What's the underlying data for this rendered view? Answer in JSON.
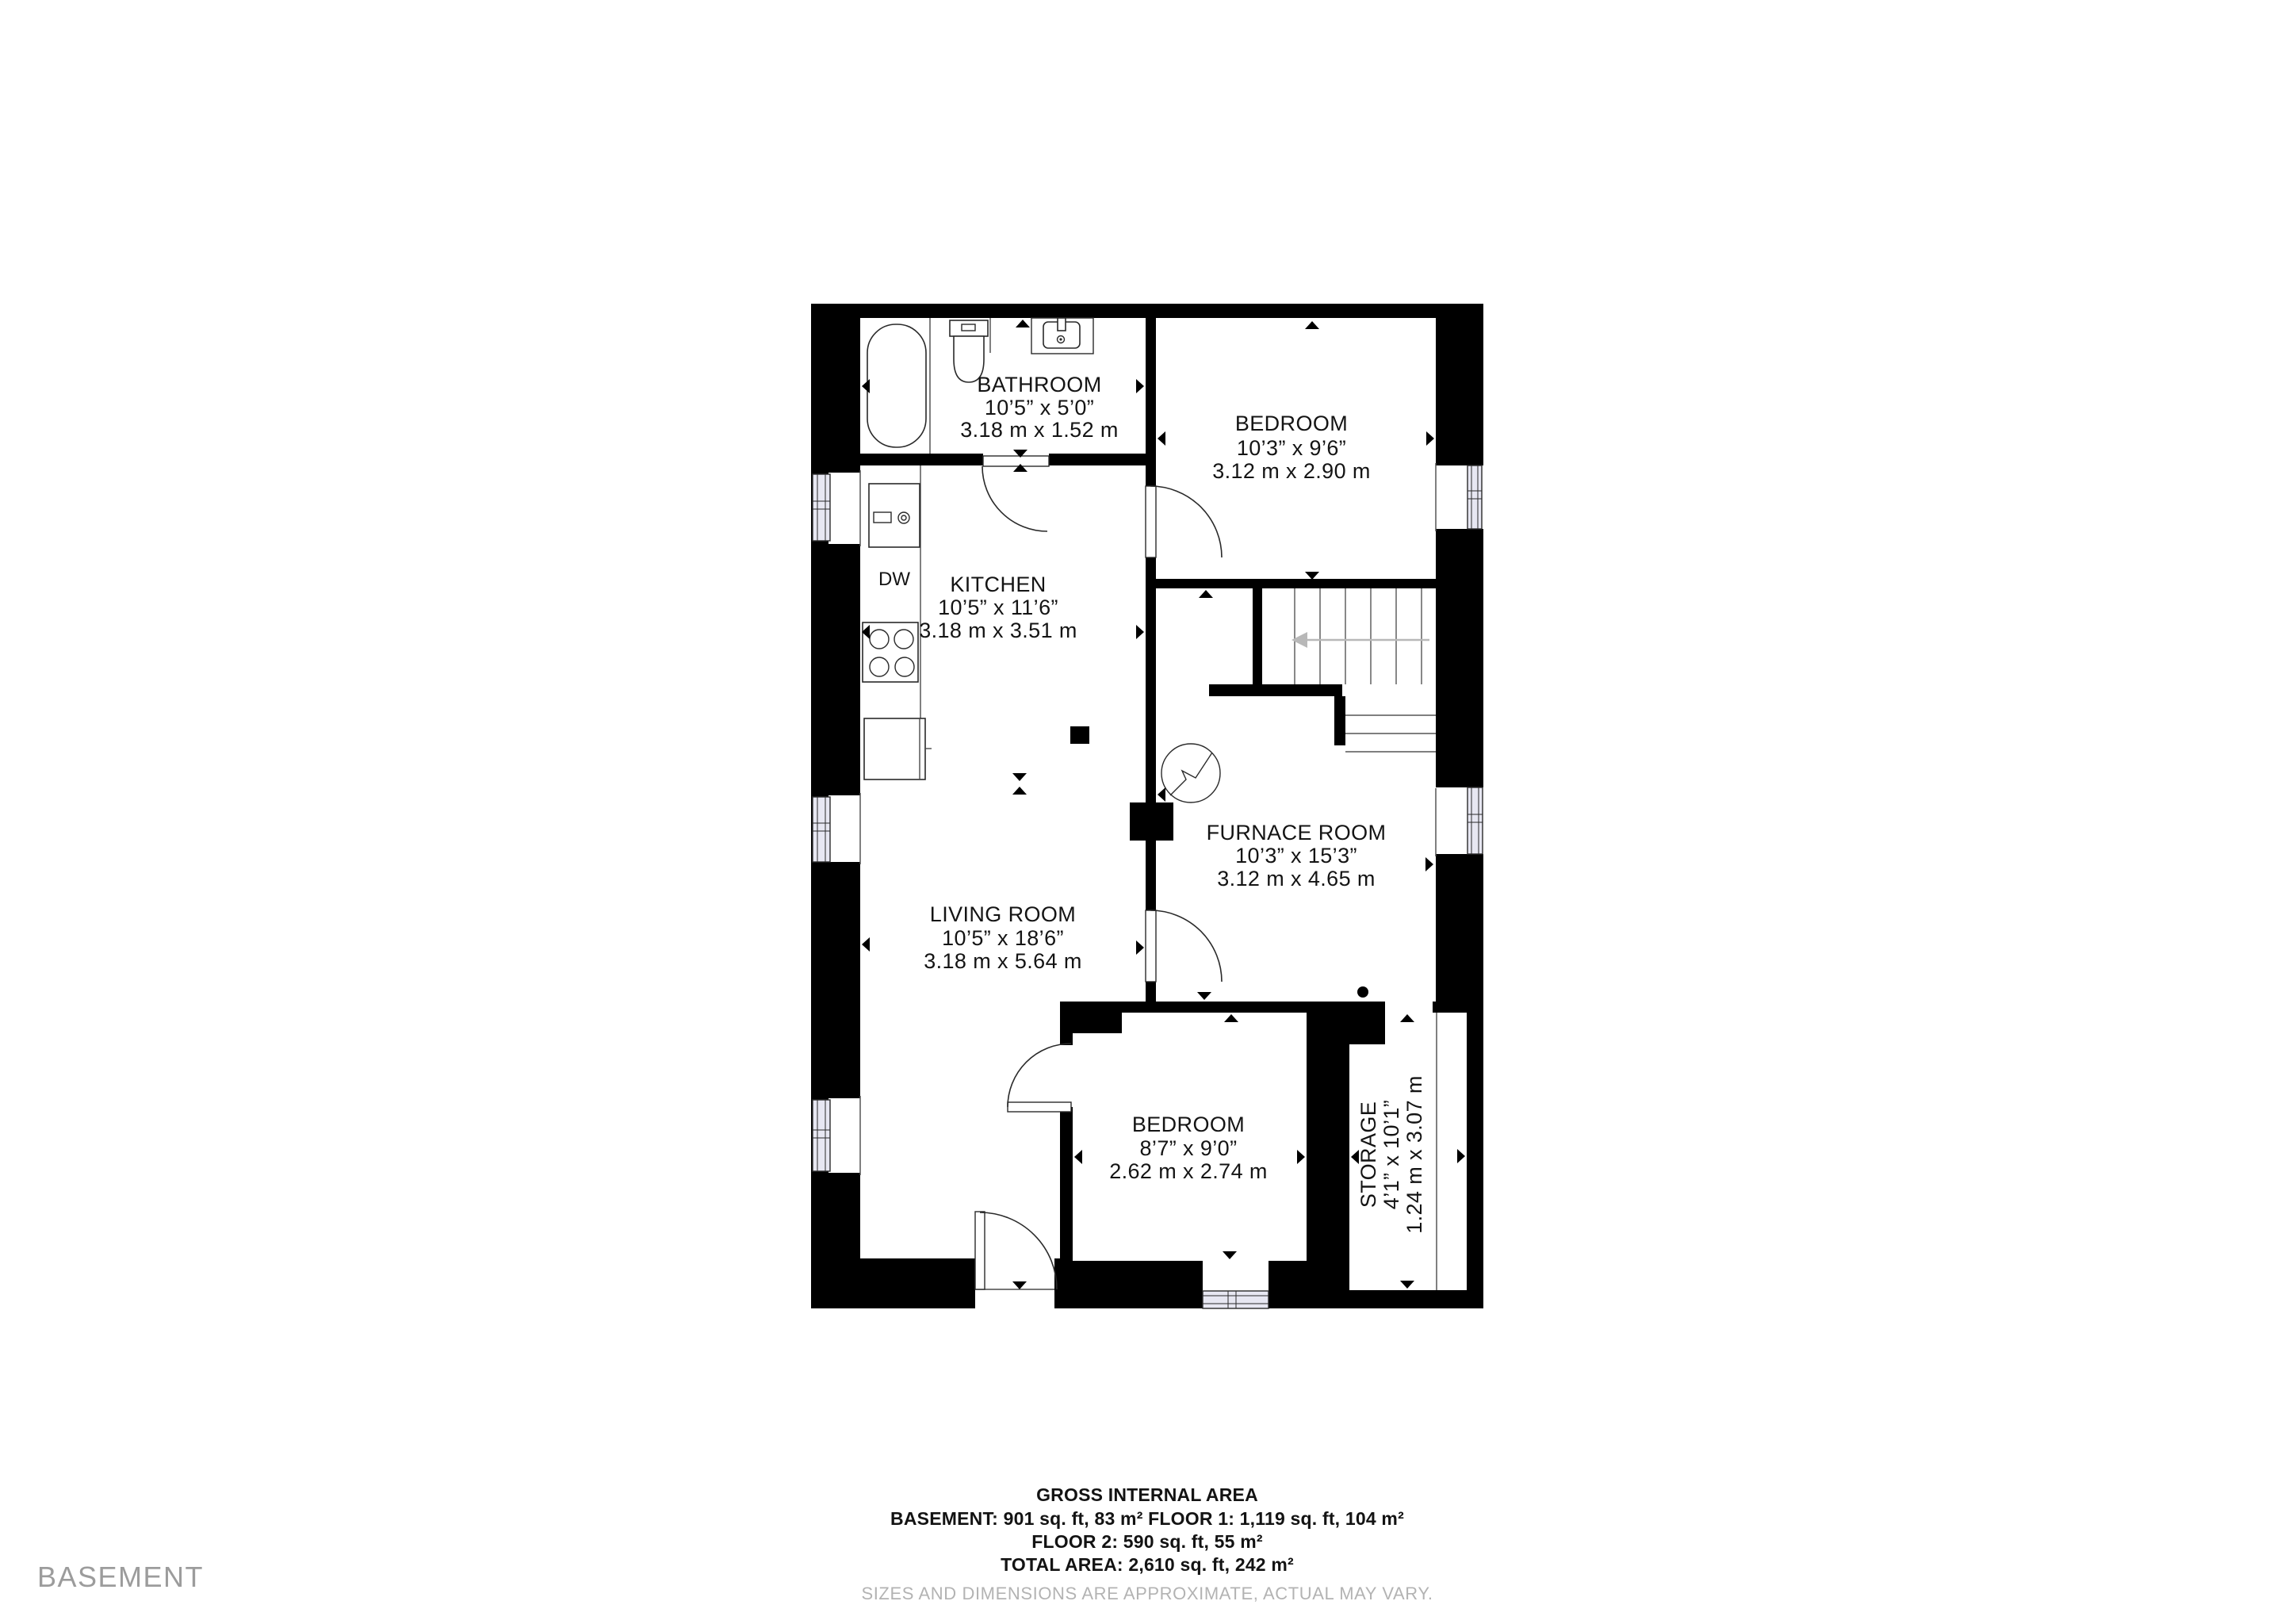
{
  "floor_label": "BASEMENT",
  "rooms": [
    {
      "name": "BATHROOM",
      "imperial": "10’5” x 5’0”",
      "metric": "3.18 m x 1.52 m"
    },
    {
      "name": "BEDROOM",
      "imperial": "10’3” x 9’6”",
      "metric": "3.12 m x 2.90 m"
    },
    {
      "name": "KITCHEN",
      "imperial": "10’5” x 11’6”",
      "metric": "3.18 m x 3.51 m"
    },
    {
      "name": "FURNACE ROOM",
      "imperial": "10’3” x 15’3”",
      "metric": "3.12 m x 4.65 m"
    },
    {
      "name": "LIVING ROOM",
      "imperial": "10’5” x 18’6”",
      "metric": "3.18 m x 5.64 m"
    },
    {
      "name": "BEDROOM",
      "imperial": "8’7” x 9’0”",
      "metric": "2.62 m x 2.74 m"
    },
    {
      "name": "STORAGE",
      "imperial": "4’1” x 10’1”",
      "metric": "1.24 m x 3.07 m"
    }
  ],
  "appliances": {
    "dishwasher": "DW"
  },
  "footer": {
    "title": "GROSS INTERNAL AREA",
    "line1": "BASEMENT: 901 sq. ft, 83 m² FLOOR 1: 1,119 sq. ft, 104 m²",
    "line2": "FLOOR 2: 590 sq. ft, 55 m²",
    "line3": "TOTAL AREA: 2,610 sq. ft, 242 m²",
    "disclaimer": "SIZES AND DIMENSIONS ARE APPROXIMATE, ACTUAL MAY VARY."
  },
  "colors": {
    "wall": "#000000",
    "background": "#ffffff",
    "window_fill": "#e7e7f2",
    "stair_arrow": "#b8b8b8",
    "floor_label_gray": "#9c9c9c",
    "disclaimer_gray": "#b3b3b3",
    "text": "#141414"
  }
}
